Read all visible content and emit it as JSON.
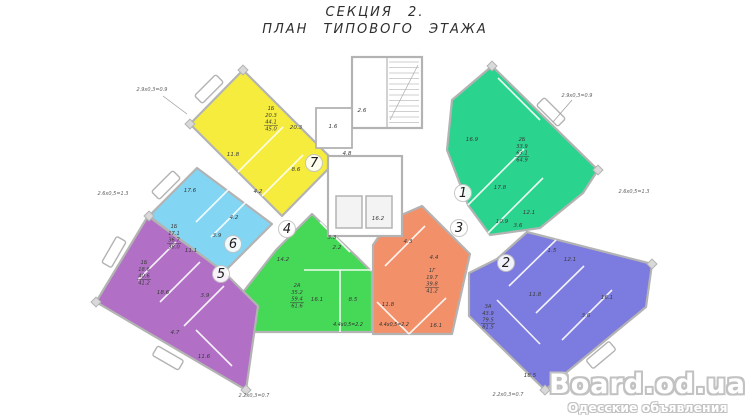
{
  "title": {
    "line1": "СЕКЦИЯ 2.",
    "line2": "ПЛАН ТИПОВОГО ЭТАЖА"
  },
  "watermark": {
    "site": "Board.od.ua",
    "tagline": "Одесские объявления"
  },
  "colors": {
    "wall": "#b3b3b3",
    "text": "#3b3b3b",
    "dim_text": "#606060",
    "hatch": "#cfcfcf",
    "paper": "#ffffff",
    "lift_fill": "#f3f3f3",
    "column": "#d9d9d9",
    "partition": "rgba(255,255,255,0.9)"
  },
  "plan": {
    "apartments": [
      {
        "id": 1,
        "label": "1",
        "color": "#2bd48e",
        "polygon": [
          [
            492,
            66
          ],
          [
            598,
            170
          ],
          [
            583,
            193
          ],
          [
            540,
            228
          ],
          [
            490,
            235
          ],
          [
            468,
            205
          ],
          [
            447,
            150
          ],
          [
            452,
            100
          ]
        ],
        "number_pos": [
          463,
          197
        ],
        "stats": {
          "x": 522,
          "y": 141,
          "lines": [
            "2Б",
            "33.9",
            "63.1",
            "64.9"
          ]
        },
        "rooms": [
          {
            "t": "16.9",
            "x": 472,
            "y": 141
          },
          {
            "t": "17.8",
            "x": 500,
            "y": 189
          },
          {
            "t": "10.9",
            "x": 502,
            "y": 223
          },
          {
            "t": "12.1",
            "x": 529,
            "y": 214
          },
          {
            "t": "3.6",
            "x": 518,
            "y": 227
          }
        ],
        "partitions": [
          [
            [
              468,
              205
            ],
            [
              524,
              149
            ]
          ],
          [
            [
              488,
              233
            ],
            [
              543,
              178
            ]
          ],
          [
            [
              498,
              78
            ],
            [
              540,
              120
            ]
          ]
        ]
      },
      {
        "id": 2,
        "label": "2",
        "color": "#7c7bdf",
        "polygon": [
          [
            527,
            232
          ],
          [
            652,
            264
          ],
          [
            646,
            307
          ],
          [
            545,
            390
          ],
          [
            469,
            316
          ],
          [
            469,
            273
          ],
          [
            497,
            259
          ]
        ],
        "number_pos": [
          506,
          267
        ],
        "stats": {
          "x": 488,
          "y": 308,
          "lines": [
            "3А",
            "43.9",
            "79.5",
            "81.5"
          ]
        },
        "rooms": [
          {
            "t": "1.5",
            "x": 552,
            "y": 252
          },
          {
            "t": "12.1",
            "x": 570,
            "y": 261
          },
          {
            "t": "11.8",
            "x": 535,
            "y": 296
          },
          {
            "t": "16.1",
            "x": 607,
            "y": 299
          },
          {
            "t": "3.6",
            "x": 586,
            "y": 317
          },
          {
            "t": "18.5",
            "x": 530,
            "y": 377
          }
        ],
        "partitions": [
          [
            [
              509,
              286
            ],
            [
              556,
              240
            ]
          ],
          [
            [
              536,
              313
            ],
            [
              584,
              266
            ]
          ],
          [
            [
              562,
              340
            ],
            [
              612,
              290
            ]
          ],
          [
            [
              497,
              300
            ],
            [
              540,
              344
            ]
          ]
        ]
      },
      {
        "id": 3,
        "label": "3",
        "color": "#f2906a",
        "polygon": [
          [
            422,
            206
          ],
          [
            470,
            254
          ],
          [
            452,
            334
          ],
          [
            373,
            334
          ],
          [
            373,
            245
          ],
          [
            390,
            220
          ]
        ],
        "number_pos": [
          459,
          232
        ],
        "stats": {
          "x": 432,
          "y": 272,
          "lines": [
            "1Г",
            "19.7",
            "39.8",
            "41.2"
          ]
        },
        "rooms": [
          {
            "t": "4.3",
            "x": 408,
            "y": 243
          },
          {
            "t": "4.4",
            "x": 434,
            "y": 259
          },
          {
            "t": "11.8",
            "x": 388,
            "y": 306
          },
          {
            "t": "16.1",
            "x": 436,
            "y": 327
          }
        ],
        "partitions": [
          [
            [
              385,
              266
            ],
            [
              425,
              226
            ]
          ],
          [
            [
              377,
              302
            ],
            [
              409,
              334
            ]
          ],
          [
            [
              409,
              334
            ],
            [
              446,
              298
            ]
          ]
        ]
      },
      {
        "id": 4,
        "label": "4",
        "color": "#46d957",
        "polygon": [
          [
            312,
            214
          ],
          [
            356,
            256
          ],
          [
            372,
            272
          ],
          [
            372,
            332
          ],
          [
            240,
            332
          ],
          [
            240,
            296
          ],
          [
            276,
            250
          ]
        ],
        "number_pos": [
          287,
          233
        ],
        "stats": {
          "x": 297,
          "y": 287,
          "lines": [
            "2А",
            "35.2",
            "59.4",
            "61.6"
          ]
        },
        "rooms": [
          {
            "t": "14.2",
            "x": 283,
            "y": 261
          },
          {
            "t": "3.3",
            "x": 332,
            "y": 239
          },
          {
            "t": "2.2",
            "x": 337,
            "y": 249
          },
          {
            "t": "16.1",
            "x": 317,
            "y": 301
          },
          {
            "t": "8.5",
            "x": 353,
            "y": 301
          }
        ],
        "partitions": [
          [
            [
              320,
              222
            ],
            [
              350,
              252
            ]
          ],
          [
            [
              340,
              270
            ],
            [
              340,
              332
            ]
          ],
          [
            [
              304,
              270
            ],
            [
              372,
              270
            ]
          ]
        ]
      },
      {
        "id": 5,
        "label": "5",
        "color": "#b170c5",
        "polygon": [
          [
            148,
            216
          ],
          [
            224,
            272
          ],
          [
            258,
            306
          ],
          [
            246,
            390
          ],
          [
            96,
            302
          ]
        ],
        "number_pos": [
          221,
          278
        ],
        "stats": {
          "x": 144,
          "y": 264,
          "lines": [
            "1Б",
            "18.6",
            "40.6",
            "41.2"
          ]
        },
        "rooms": [
          {
            "t": "18.6",
            "x": 163,
            "y": 294
          },
          {
            "t": "3.9",
            "x": 205,
            "y": 297
          },
          {
            "t": "4.7",
            "x": 175,
            "y": 334
          },
          {
            "t": "11.6",
            "x": 204,
            "y": 358
          }
        ],
        "partitions": [
          [
            [
              176,
              242
            ],
            [
              138,
              280
            ]
          ],
          [
            [
              200,
              262
            ],
            [
              160,
              302
            ]
          ],
          [
            [
              224,
              286
            ],
            [
              184,
              326
            ]
          ],
          [
            [
              196,
              330
            ],
            [
              232,
              366
            ]
          ]
        ]
      },
      {
        "id": 6,
        "label": "6",
        "color": "#82d6f3",
        "polygon": [
          [
            197,
            168
          ],
          [
            272,
            224
          ],
          [
            224,
            272
          ],
          [
            149,
            216
          ]
        ],
        "number_pos": [
          233,
          248
        ],
        "stats": {
          "x": 174,
          "y": 228,
          "lines": [
            "1Б",
            "17.1",
            "36.7",
            "38.0"
          ]
        },
        "rooms": [
          {
            "t": "17.6",
            "x": 190,
            "y": 192
          },
          {
            "t": "4.2",
            "x": 234,
            "y": 219
          },
          {
            "t": "3.9",
            "x": 217,
            "y": 237
          },
          {
            "t": "11.1",
            "x": 191,
            "y": 252
          }
        ],
        "partitions": [
          [
            [
              232,
              186
            ],
            [
              196,
              222
            ]
          ],
          [
            [
              247,
              201
            ],
            [
              211,
              237
            ]
          ]
        ]
      },
      {
        "id": 7,
        "label": "7",
        "color": "#f5ec3d",
        "polygon": [
          [
            243,
            70
          ],
          [
            335,
            162
          ],
          [
            282,
            216
          ],
          [
            190,
            124
          ]
        ],
        "number_pos": [
          314,
          167
        ],
        "stats": {
          "x": 271,
          "y": 110,
          "lines": [
            "1Б",
            "20.3",
            "44.1",
            "45.0"
          ]
        },
        "rooms": [
          {
            "t": "20.3",
            "x": 296,
            "y": 129
          },
          {
            "t": "11.8",
            "x": 233,
            "y": 156
          },
          {
            "t": "8.6",
            "x": 296,
            "y": 171
          },
          {
            "t": "4.2",
            "x": 258,
            "y": 193
          }
        ],
        "partitions": [
          [
            [
              238,
              172
            ],
            [
              283,
              127
            ]
          ],
          [
            [
              262,
              196
            ],
            [
              303,
              155
            ]
          ]
        ]
      }
    ],
    "core": {
      "stair_rect": [
        352,
        57,
        70,
        71
      ],
      "vestibule_rect": [
        316,
        108,
        36,
        40
      ],
      "lift_core_rect": [
        328,
        156,
        74,
        80
      ],
      "lifts": [
        [
          336,
          196,
          26,
          32
        ],
        [
          366,
          196,
          26,
          32
        ]
      ],
      "labels": [
        {
          "t": "2.6",
          "x": 362,
          "y": 112
        },
        {
          "t": "1.6",
          "x": 333,
          "y": 128
        },
        {
          "t": "4.8",
          "x": 347,
          "y": 155
        },
        {
          "t": "16.2",
          "x": 378,
          "y": 220
        }
      ]
    },
    "balconies": [
      {
        "x": 209,
        "y": 89,
        "angle": -45
      },
      {
        "x": 166,
        "y": 185,
        "angle": -45
      },
      {
        "x": 114,
        "y": 252,
        "angle": -60
      },
      {
        "x": 551,
        "y": 112,
        "angle": 45
      },
      {
        "x": 601,
        "y": 355,
        "angle": -40
      },
      {
        "x": 168,
        "y": 358,
        "angle": 30
      }
    ],
    "columns": [
      [
        243,
        70
      ],
      [
        190,
        124
      ],
      [
        149,
        216
      ],
      [
        96,
        302
      ],
      [
        246,
        390
      ],
      [
        492,
        66
      ],
      [
        598,
        170
      ],
      [
        652,
        264
      ],
      [
        545,
        390
      ]
    ],
    "dim_labels": [
      {
        "t": "2.9x0,3=0.9",
        "x": 152,
        "y": 91
      },
      {
        "t": "2.9x0,3=0.9",
        "x": 577,
        "y": 97
      },
      {
        "t": "2.6x0,5=1.3",
        "x": 113,
        "y": 195
      },
      {
        "t": "2.6x0,5=1.3",
        "x": 634,
        "y": 193
      },
      {
        "t": "2.2x0,3=0.7",
        "x": 254,
        "y": 397
      },
      {
        "t": "2.2x0,3=0.7",
        "x": 508,
        "y": 396
      }
    ],
    "leaders": [
      [
        572,
        100,
        553,
        122
      ],
      [
        163,
        96,
        187,
        114
      ]
    ],
    "calc_labels": [
      {
        "t": "4.4x0,5=2.2",
        "x": 348,
        "y": 326
      },
      {
        "t": "4.4x0,5=2.2",
        "x": 394,
        "y": 326
      }
    ]
  }
}
